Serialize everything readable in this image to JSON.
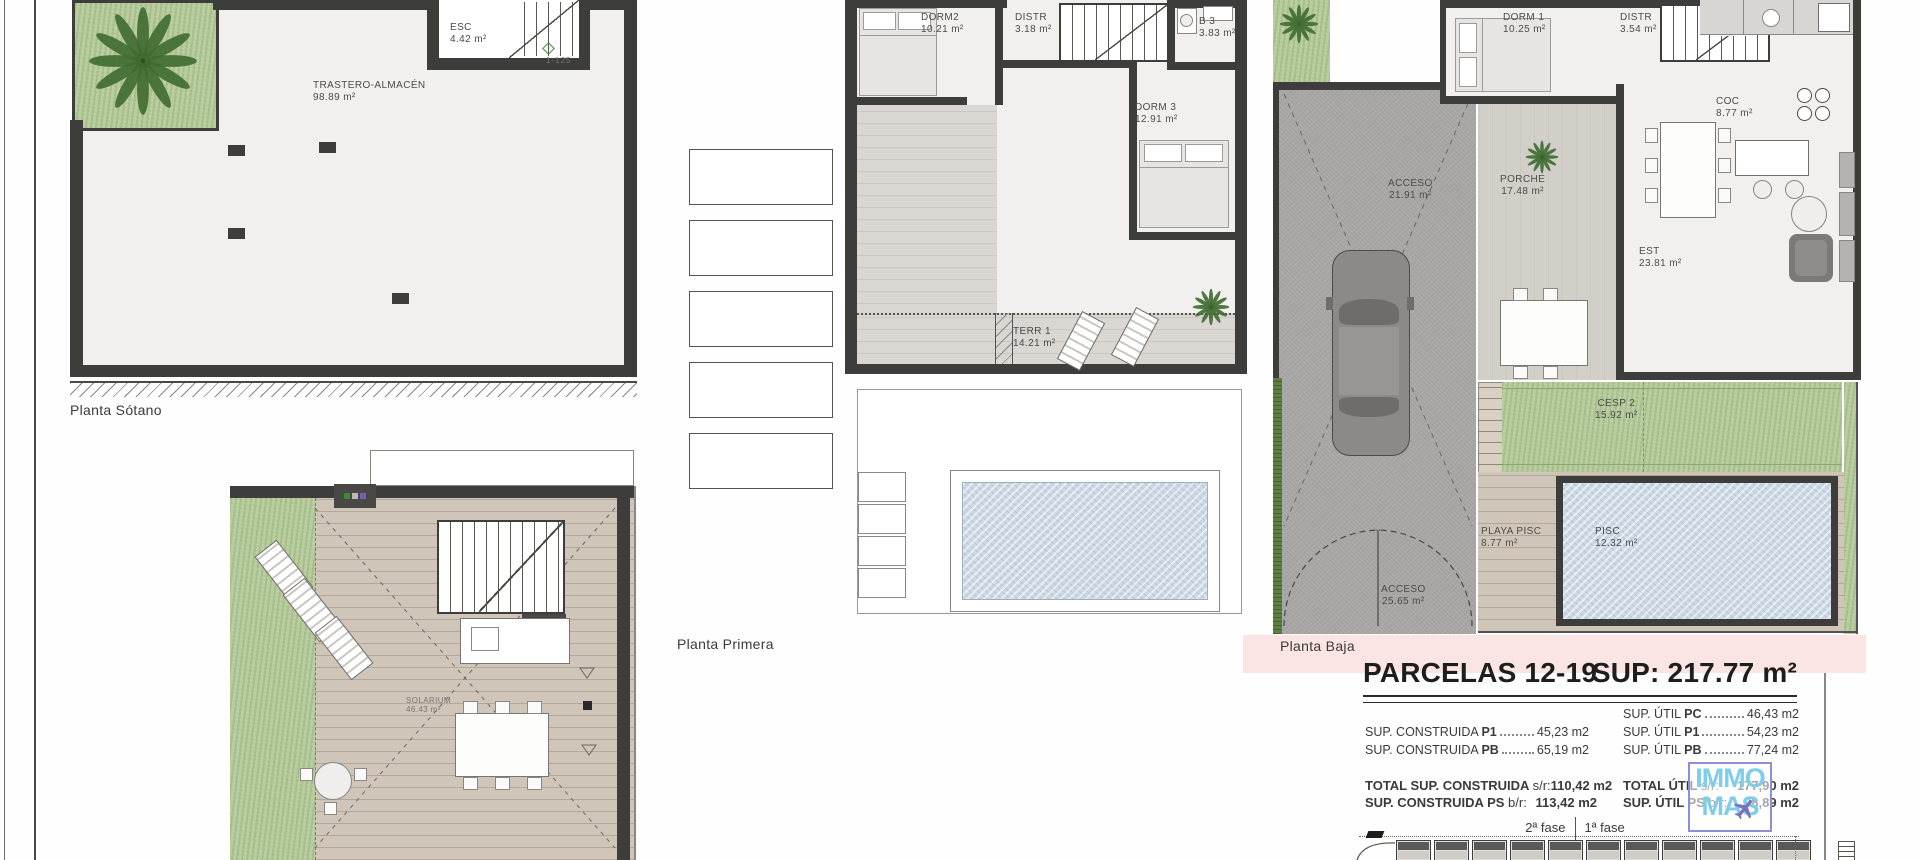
{
  "plans": {
    "sotano": {
      "label": "Planta Sótano",
      "scale_note": "1-125",
      "rooms": {
        "trastero": {
          "name": "TRASTERO-ALMACÉN",
          "area": "98.89 m²"
        },
        "esc": {
          "name": "ESC",
          "area": "4.42 m²"
        }
      }
    },
    "cubierta": {
      "rooms": {
        "solarium": {
          "name": "SOLARIUM",
          "area": "46.43 m²"
        }
      }
    },
    "primera": {
      "label": "Planta Primera",
      "rooms": {
        "dorm2": {
          "name": "DORM2",
          "area": "10.21 m²"
        },
        "distr": {
          "name": "DISTR",
          "area": "3.18 m²"
        },
        "b3": {
          "name": "B 3",
          "area": "3.83 m²"
        },
        "dorm3": {
          "name": "DORM 3",
          "area": "12.91 m²"
        },
        "terr1": {
          "name": "TERR 1",
          "area": "14.21 m²"
        }
      }
    },
    "baja": {
      "label": "Planta Baja",
      "rooms": {
        "dorm1": {
          "name": "DORM 1",
          "area": "10.25 m²"
        },
        "distr": {
          "name": "DISTR",
          "area": "3.54 m²"
        },
        "esc": {
          "name": "ESC",
          "area": "4.03 m²"
        },
        "as": {
          "name": "A.S",
          "area": ""
        },
        "coc": {
          "name": "COC",
          "area": "8.77 m²"
        },
        "acceso": {
          "name": "ACCESO",
          "area": "21.91 m²"
        },
        "porche": {
          "name": "PORCHE",
          "area": "17.48 m²"
        },
        "est": {
          "name": "EST",
          "area": "23.81 m²"
        },
        "cesp2": {
          "name": "CESP 2",
          "area": "15.92 m²"
        },
        "playa": {
          "name": "PLAYA PISC",
          "area": "8.77 m²"
        },
        "pisc": {
          "name": "PISC",
          "area": "12.32 m²"
        },
        "acceso2": {
          "name": "ACCESO",
          "area": "25.65 m²"
        }
      }
    }
  },
  "summary": {
    "title": "PARCELAS 12-19",
    "sup_total": "SUP: 217.77 m²",
    "rows_left": [
      {
        "label": "SUP. CONSTRUIDA ",
        "code": "P1",
        "value": "45,23 m2"
      },
      {
        "label": "SUP. CONSTRUIDA ",
        "code": "PB",
        "value": "65,19 m2"
      }
    ],
    "rows_right": [
      {
        "label": "SUP. ÚTIL ",
        "code": "PC",
        "value": "46,43 m2"
      },
      {
        "label": "SUP. ÚTIL ",
        "code": "P1",
        "value": "54,23 m2"
      },
      {
        "label": "SUP. ÚTIL ",
        "code": "PB",
        "value": "77,24 m2"
      }
    ],
    "totals_left": [
      {
        "label": "TOTAL SUP. CONSTRUIDA",
        "suffix": "s/r:",
        "value": "110,42 m2"
      },
      {
        "label": "SUP. CONSTRUIDA PS",
        "suffix": "b/r:",
        "value": "113,42 m2"
      }
    ],
    "totals_right": [
      {
        "label": "TOTAL ÚTIL",
        "suffix": "s/r:",
        "value": "177,90 m2"
      },
      {
        "label": "SUP. ÚTIL PS",
        "suffix": "b/r:",
        "value": "98,89 m2"
      }
    ],
    "phase_left": "2ª fase",
    "phase_right": "1ª fase"
  },
  "logo": {
    "line1": "IMMO",
    "line2": "MAS"
  },
  "colors": {
    "wall": "#3d3d3b",
    "grass": "#b7cc9c",
    "hedge": "#5f7f42",
    "pool_water": "#ccd9e4",
    "driveway": "#a9a8a6",
    "deck_wood": "#cfc5b9",
    "porch": "#d2cec8",
    "pink_band": "#fbe4e4",
    "logo_blue": "#7fcdec",
    "logo_purple": "#7a72bf",
    "logo_border": "#8a8fd6",
    "ink": "#3a3a38"
  }
}
